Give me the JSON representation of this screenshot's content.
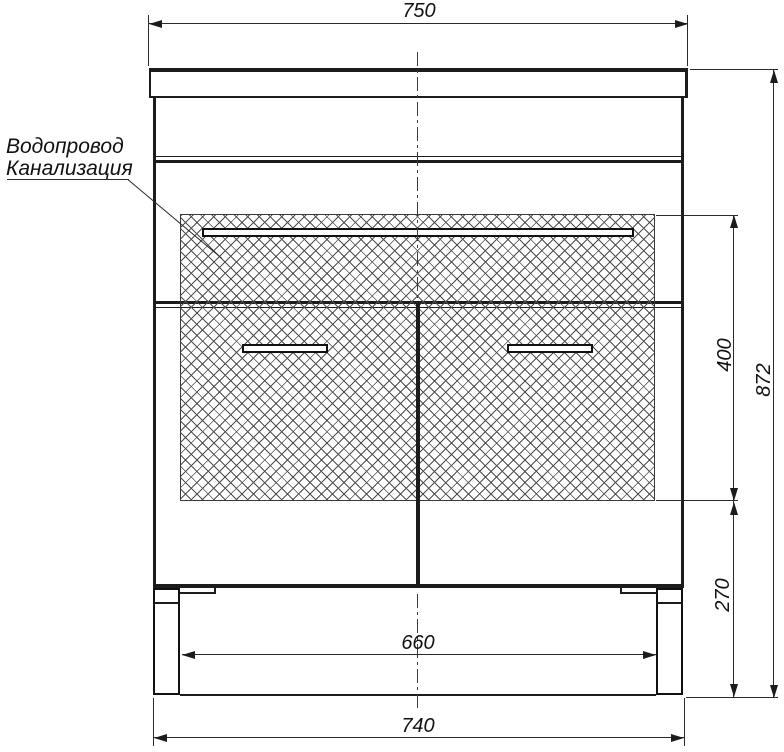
{
  "annotations": {
    "water_supply": "Водопровод",
    "sewerage": "Канализация"
  },
  "dimensions": {
    "top_width": "750",
    "overall_height": "872",
    "service_zone_height": "400",
    "leg_zone_height": "270",
    "inner_leg_span": "660",
    "base_width": "740"
  }
}
